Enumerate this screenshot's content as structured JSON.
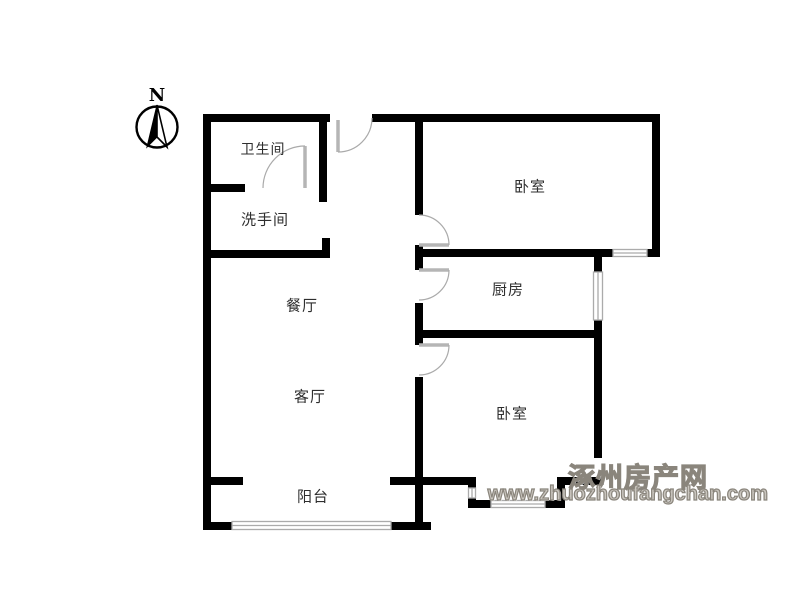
{
  "compass": {
    "north_label": "N"
  },
  "rooms": {
    "bathroom": {
      "label": "卫生间"
    },
    "washroom": {
      "label": "洗手间"
    },
    "bedroom_top": {
      "label": "卧室"
    },
    "kitchen": {
      "label": "厨房"
    },
    "dining_room": {
      "label": "餐厅"
    },
    "living_room": {
      "label": "客厅"
    },
    "bedroom_bottom": {
      "label": "卧室"
    },
    "balcony": {
      "label": "阳台"
    }
  },
  "watermark": {
    "site_name": "涿州房产网",
    "site_url": "www.zhuozhoufangchan.com"
  },
  "colors": {
    "wall": "#000000",
    "door": "#b5b5b5",
    "door_arc": "#aaaaaa",
    "window_frame": "#ababab",
    "watermark_text": "#8f8a82"
  }
}
